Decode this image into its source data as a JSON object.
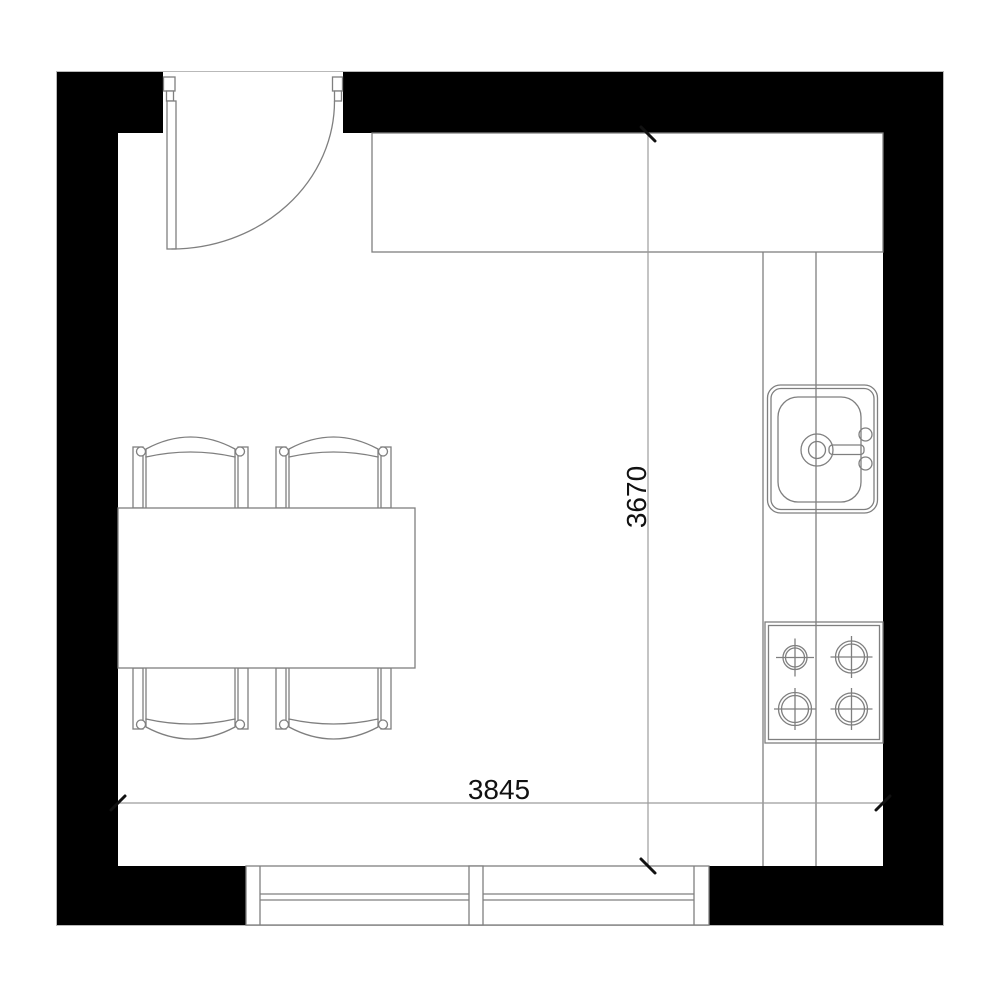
{
  "title": "Kitchen floor plan",
  "dimensions": {
    "horizontal": {
      "label": "3845"
    },
    "vertical": {
      "label": "3670"
    }
  },
  "colors": {
    "background": "#ffffff",
    "wall": "#000000",
    "furniture_line": "#7f7f7f",
    "dimension_line": "#9c9c9c",
    "text": "#111111"
  },
  "fixtures": [
    "entry-door",
    "window",
    "kitchen-counter-top",
    "kitchen-counter-right",
    "kitchen-sink",
    "stove-cooktop",
    "dining-table",
    "chair-top-left",
    "chair-top-right",
    "chair-bottom-left",
    "chair-bottom-right"
  ]
}
